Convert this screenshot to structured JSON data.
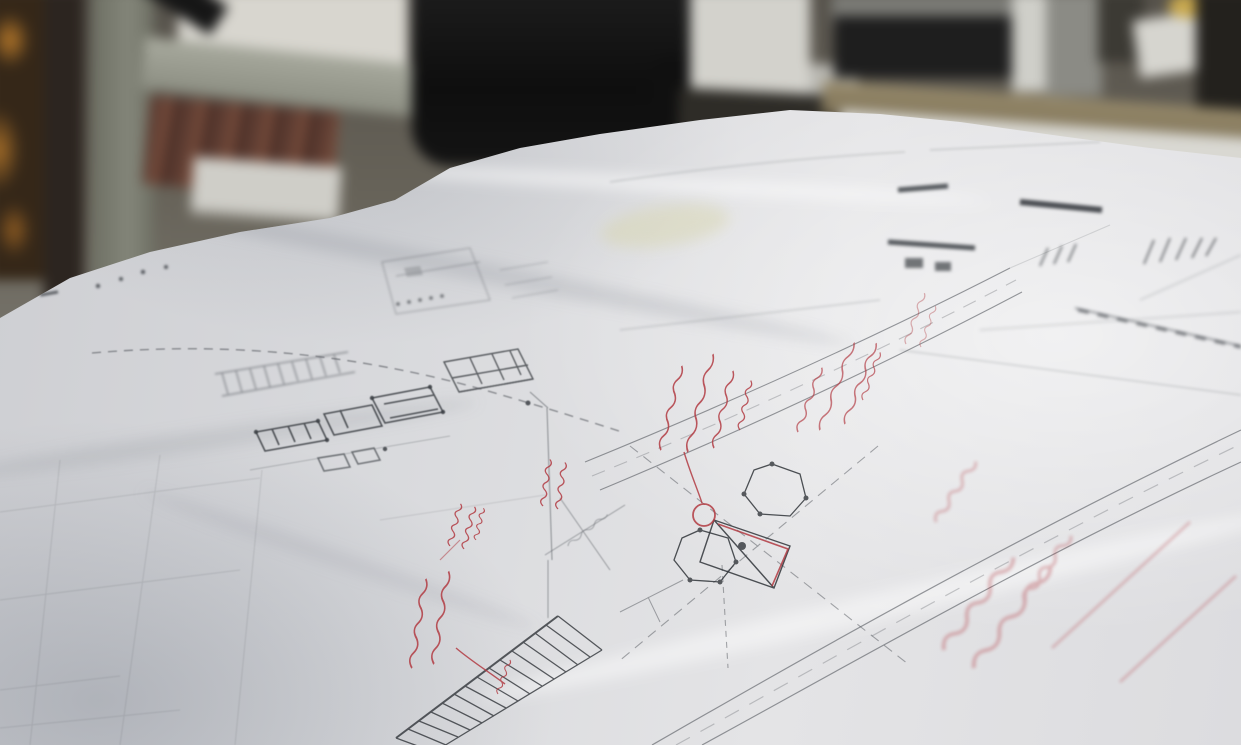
{
  "scene": {
    "type": "photograph",
    "subject": "hand-drawn architectural site plan with red pen markups lying flat on a drafting desk, shot at a shallow oblique angle",
    "background": "out-of-focus office: black office chair, shelving with books, cabinet, printer and stacks of white paper",
    "readable_text": "none - all handwriting and pencil notes are too small/blurred to be legible"
  },
  "palette": {
    "red_ink": "#b23a42",
    "faded_red_ink": "#c86b72",
    "pencil": "#54585e",
    "dark_pencil": "#303439",
    "paper": "#dadbde",
    "chair_black": "#141414",
    "wood_shelf": "#6b4434",
    "desk_edge_tan": "#8b7f62",
    "amber_glow": "#b97a2a",
    "accent_yellow": "#c9a94e"
  },
  "background_objects": [
    {
      "name": "amber-light-blobs",
      "area": [
        0,
        0,
        55,
        290
      ]
    },
    {
      "name": "cabinet-column",
      "area": [
        92,
        0,
        155,
        350
      ]
    },
    {
      "name": "desk-lamp-arm",
      "area": [
        118,
        0,
        220,
        60
      ]
    },
    {
      "name": "bright-wall",
      "area": [
        178,
        0,
        408,
        65
      ]
    },
    {
      "name": "shelf-with-books",
      "area": [
        142,
        52,
        440,
        192
      ]
    },
    {
      "name": "drawer-front",
      "area": [
        192,
        162,
        340,
        214
      ]
    },
    {
      "name": "office-chair-back",
      "area": [
        412,
        0,
        694,
        166
      ]
    },
    {
      "name": "white-column",
      "area": [
        690,
        0,
        810,
        130
      ]
    },
    {
      "name": "printer-unit",
      "area": [
        834,
        0,
        1020,
        78
      ]
    },
    {
      "name": "paper-stacks-on-desk",
      "area": [
        838,
        60,
        1241,
        186
      ]
    },
    {
      "name": "tan-desk-edge",
      "area": [
        822,
        96,
        1241,
        150
      ]
    },
    {
      "name": "yellow-round-object",
      "area": [
        1168,
        0,
        1208,
        18
      ]
    }
  ],
  "drawing_elements": [
    {
      "name": "faint-building-plan-upper",
      "area": [
        380,
        245,
        492,
        315
      ]
    },
    {
      "name": "dark-building-cluster-left",
      "area": [
        250,
        385,
        450,
        475
      ]
    },
    {
      "name": "building-cluster-center",
      "area": [
        440,
        345,
        535,
        425
      ]
    },
    {
      "name": "dashed-utility-line",
      "from": [
        92,
        353
      ],
      "to": [
        622,
        432
      ]
    },
    {
      "name": "hatched-road-band-left",
      "area": [
        215,
        350,
        355,
        396
      ]
    },
    {
      "name": "upper-road-double-line",
      "from": [
        585,
        462
      ],
      "to": [
        1022,
        292
      ]
    },
    {
      "name": "lower-road-double-line",
      "from": [
        652,
        745
      ],
      "to": [
        1241,
        430
      ]
    },
    {
      "name": "crossing-diagonal-lines",
      "area": [
        618,
        443,
        908,
        668
      ]
    },
    {
      "name": "tank-hexagon-symbols",
      "centers": [
        [
          772,
          492
        ],
        [
          702,
          558
        ]
      ]
    },
    {
      "name": "connector-structure",
      "area": [
        700,
        520,
        790,
        588
      ]
    },
    {
      "name": "stair-hatch-band",
      "area": [
        396,
        616,
        602,
        745
      ]
    },
    {
      "name": "dimension-vertical-line",
      "from": [
        547,
        408
      ],
      "to": [
        552,
        560
      ]
    },
    {
      "name": "faint-scale-note",
      "area": [
        560,
        515,
        610,
        550
      ],
      "legible": false
    },
    {
      "name": "dark-bars-right",
      "area": [
        888,
        180,
        1105,
        275
      ]
    },
    {
      "name": "tick-marks-right",
      "area": [
        1038,
        238,
        1218,
        270
      ]
    },
    {
      "name": "dashed-band-far-right",
      "from": [
        1075,
        308
      ],
      "to": [
        1241,
        346
      ]
    },
    {
      "name": "paper-edge-dots",
      "points": [
        [
          98,
          286
        ],
        [
          121,
          279
        ],
        [
          143,
          272
        ],
        [
          166,
          267
        ]
      ]
    }
  ],
  "annotations": [
    {
      "name": "red-note-left-tall",
      "area": [
        405,
        540,
        470,
        670
      ],
      "lines": 2,
      "orientation_deg": -78,
      "legible": false,
      "has_leader": true
    },
    {
      "name": "red-note-left-small",
      "area": [
        448,
        500,
        485,
        550
      ],
      "lines": 3,
      "orientation_deg": -70,
      "legible": false
    },
    {
      "name": "red-note-upper-pair",
      "area": [
        540,
        458,
        575,
        512
      ],
      "lines": 2,
      "orientation_deg": -76,
      "legible": false
    },
    {
      "name": "red-note-center",
      "area": [
        655,
        345,
        760,
        452
      ],
      "lines": 4,
      "orientation_deg": -73,
      "legible": false,
      "has_leader": true,
      "leader_target": "red-circle-markup"
    },
    {
      "name": "red-circle-markup",
      "center": [
        704,
        515
      ],
      "radius": 11
    },
    {
      "name": "red-trace-on-structure",
      "path": [
        [
          718,
          524
        ],
        [
          788,
          549
        ],
        [
          772,
          586
        ]
      ]
    },
    {
      "name": "red-note-along-road",
      "area": [
        795,
        300,
        885,
        432
      ],
      "lines": 4,
      "orientation_deg": -66,
      "legible": false
    },
    {
      "name": "red-note-small-right",
      "area": [
        902,
        305,
        945,
        348
      ],
      "lines": 2,
      "orientation_deg": -66,
      "legible": false
    },
    {
      "name": "red-note-large-faded",
      "area": [
        925,
        470,
        1240,
        690
      ],
      "lines": 4,
      "orientation_deg": -49,
      "legible": false,
      "out_of_focus": true
    }
  ]
}
